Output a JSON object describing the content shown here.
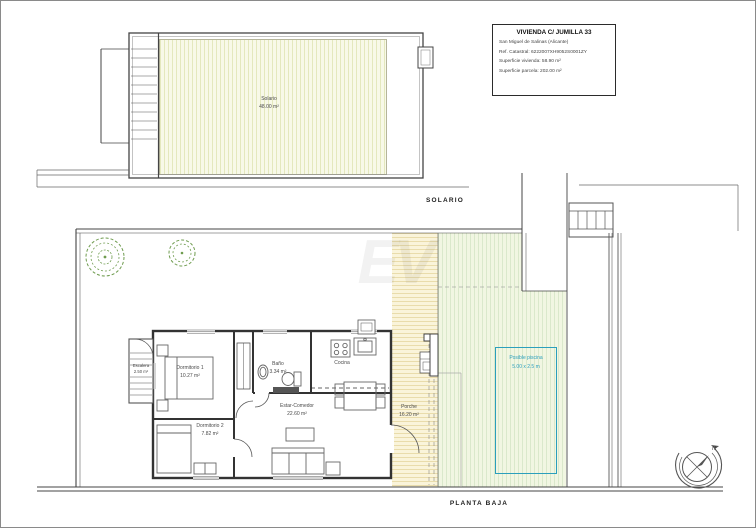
{
  "title_block": {
    "title": "VIVIENDA C/ JUMILLA 33",
    "lines": [
      "San Miguel de Salinas (Alicante)",
      "Ref. Catastral: 6222007XH9052S0001ZY",
      "Superficie vivienda: 58.90 m²",
      "Superficie parcela: 202.00 m²"
    ]
  },
  "floor_labels": {
    "upper": "SOLARIO",
    "lower": "PLANTA BAJA"
  },
  "solarium": {
    "name": "Solario",
    "area": "48.00 m²"
  },
  "rooms": [
    {
      "id": "dormitorio1",
      "name": "Dormitorio 1",
      "area": "10.27 m²"
    },
    {
      "id": "dormitorio2",
      "name": "Dormitorio 2",
      "area": "7.82 m²"
    },
    {
      "id": "bano",
      "name": "Baño",
      "area": "3.34 m²"
    },
    {
      "id": "cocina",
      "name": "Cocina",
      "area": ""
    },
    {
      "id": "estar",
      "name": "Estar-Comedor",
      "area": "22.60 m²"
    },
    {
      "id": "escalera",
      "name": "Escalera",
      "area": "2.50 m²"
    },
    {
      "id": "porche",
      "name": "Porche",
      "area": "16.20 m²"
    }
  ],
  "pool": {
    "line1": "Posible piscina",
    "line2": "5.00 x 2.5 m",
    "accent_color": "#2b9fbc"
  },
  "compass": {
    "north_label": "N"
  },
  "watermark": "EV",
  "colors": {
    "walls": "#333333",
    "solario_hatch": "#f8f9e8",
    "garden_hatch": "#f1f6e2",
    "terrace_hatch": "#faf4da",
    "tree_green": "#6f9c4f"
  }
}
